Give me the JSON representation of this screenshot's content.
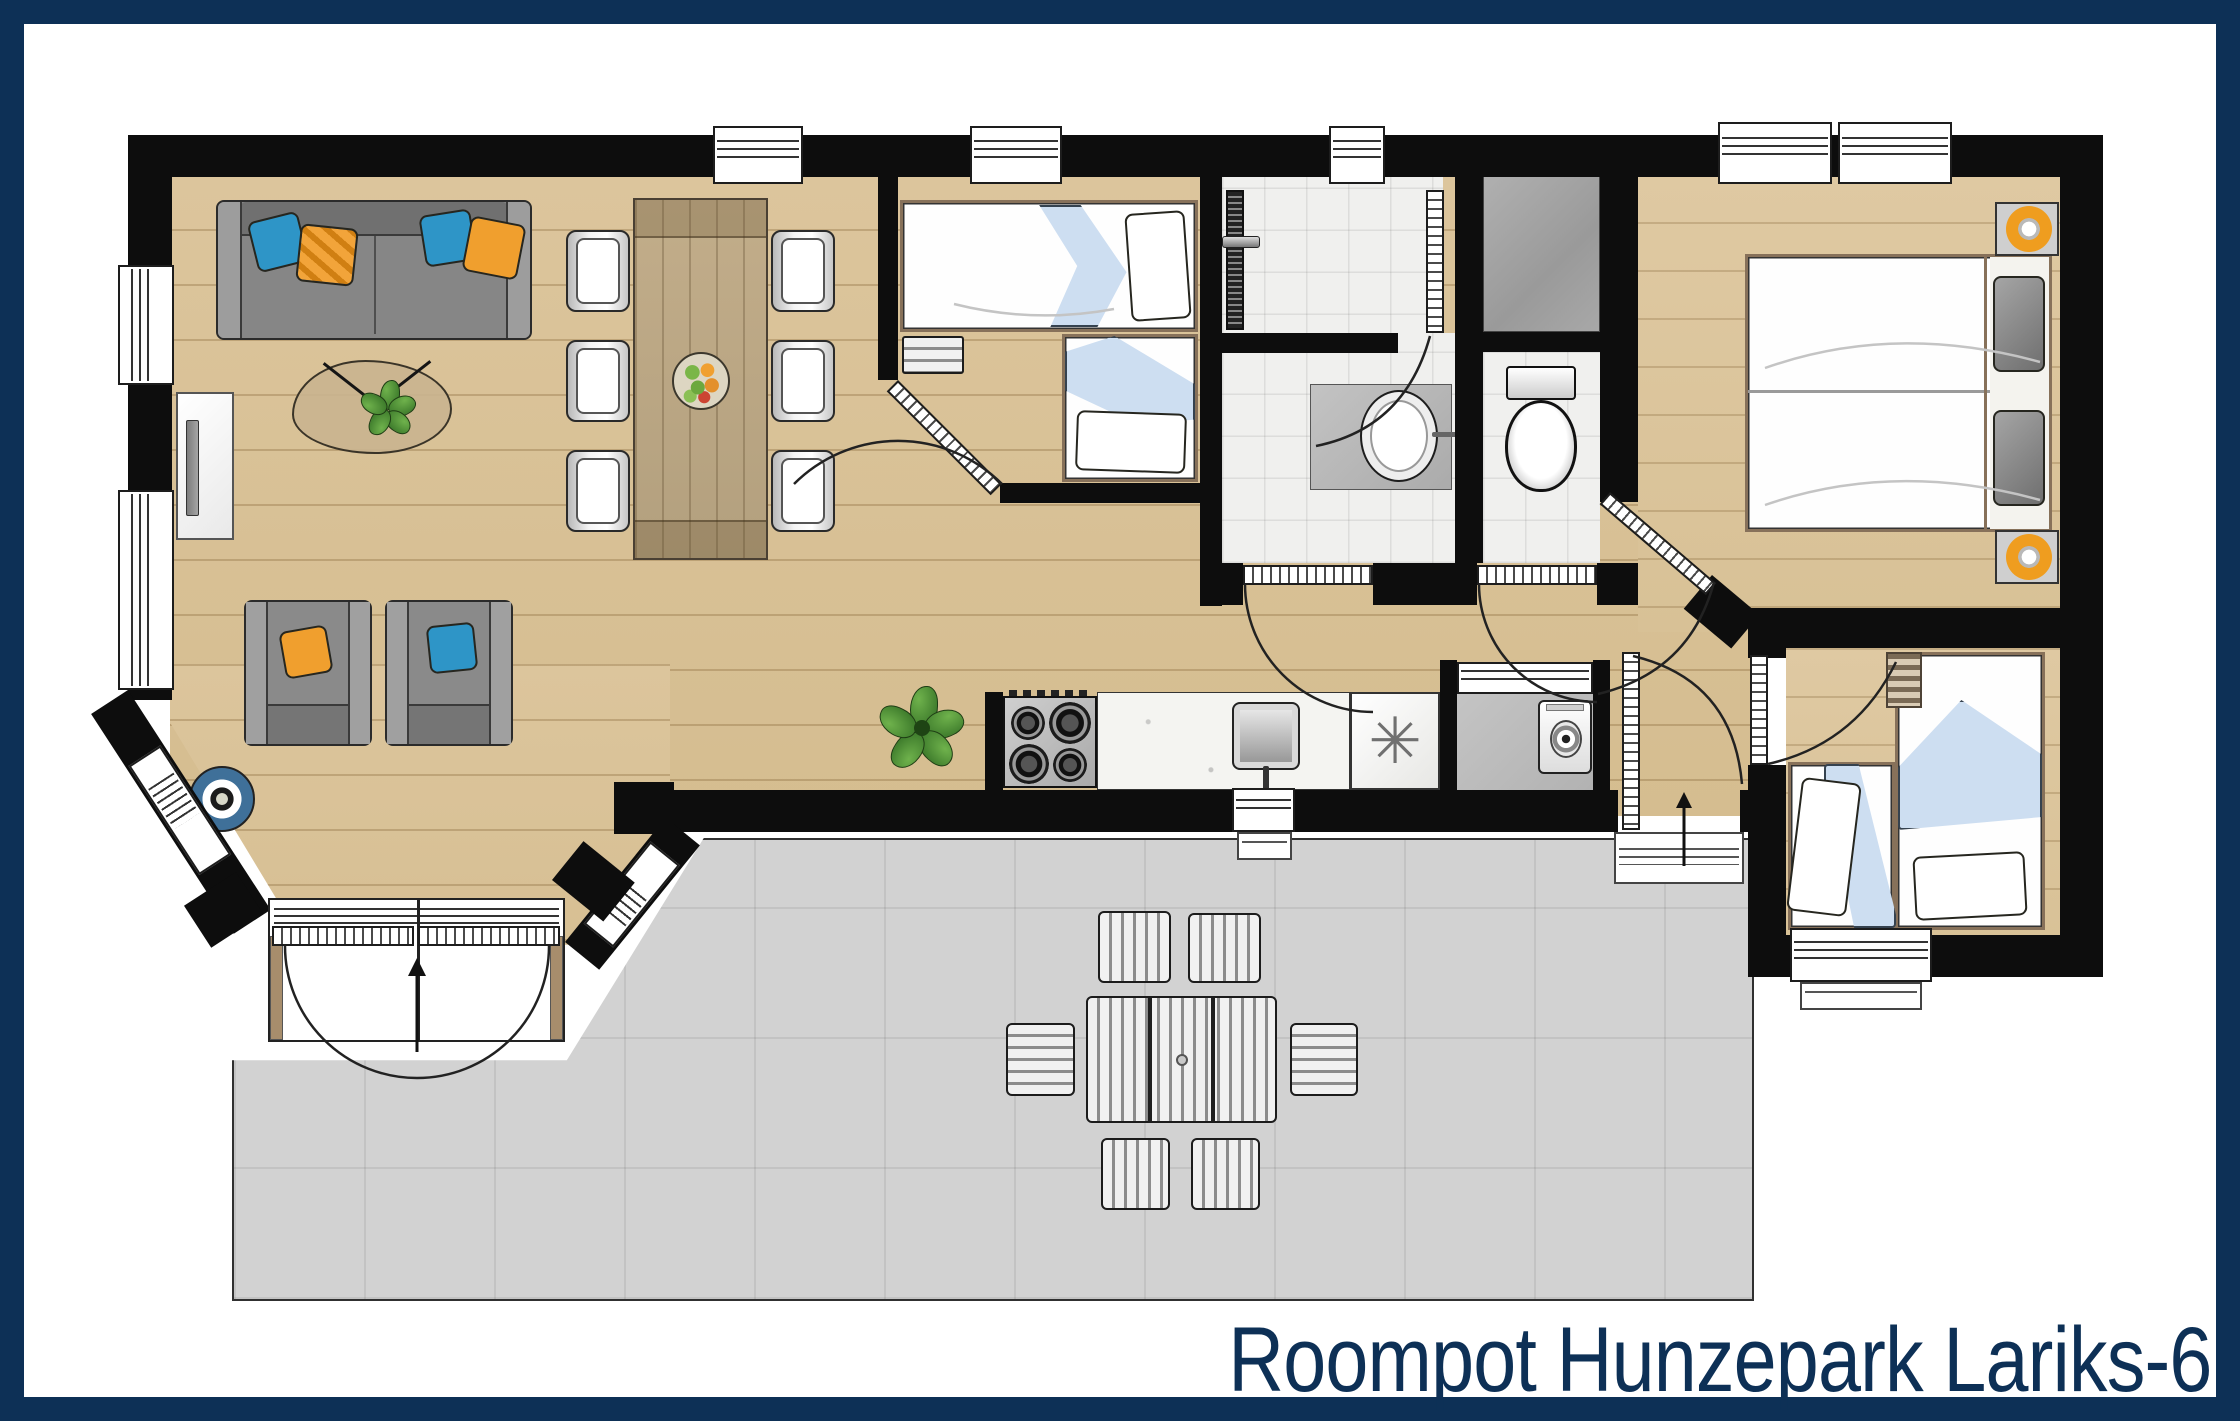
{
  "title": "Roompot Hunzepark Lariks-6",
  "glyphs": {
    "dishwasher": "✳"
  },
  "theme": {
    "navy": "#0d3056",
    "wall": "#0d0d0d",
    "wood": "#d8c095",
    "terrace": "#d2d2d2",
    "tile": "#f0f0ee",
    "sofa_gray": "#868686",
    "pillow_blue": "#2e95c7",
    "pillow_orange": "#f09f2e",
    "fold_blue": "#cddef1",
    "frame_brown": "#87715a",
    "table_wood": "#b9a584",
    "lamp_orange": "#ef9d1f",
    "closet_gray": "#a3a3a3"
  },
  "rooms": [
    {
      "name": "living-room",
      "furniture": [
        "sofa",
        "throw-pillows",
        "tv-cabinet",
        "coffee-table",
        "houseplant",
        "armchair",
        "armchair",
        "speaker"
      ]
    },
    {
      "name": "dining-area",
      "furniture": [
        "dining-table",
        "fruit-bowl",
        "dining-chair",
        "dining-chair",
        "dining-chair",
        "dining-chair",
        "dining-chair",
        "dining-chair"
      ]
    },
    {
      "name": "kitchen",
      "furniture": [
        "gas-hob",
        "counter",
        "kitchen-sink",
        "dishwasher",
        "houseplant"
      ]
    },
    {
      "name": "utility-room",
      "furniture": [
        "washing-machine"
      ]
    },
    {
      "name": "bathroom",
      "furniture": [
        "shower",
        "shower-drain",
        "washbasin",
        "vanity"
      ]
    },
    {
      "name": "toilet-room",
      "furniture": [
        "toilet",
        "storage-closet"
      ]
    },
    {
      "name": "bedroom-1",
      "furniture": [
        "single-bed",
        "single-bed",
        "bench"
      ]
    },
    {
      "name": "bedroom-2",
      "furniture": [
        "double-bed",
        "nightstand-lamp",
        "nightstand-lamp"
      ]
    },
    {
      "name": "bedroom-3",
      "furniture": [
        "single-bed",
        "single-bed",
        "ladder"
      ]
    },
    {
      "name": "terrace",
      "furniture": [
        "garden-table",
        "garden-chair",
        "garden-chair",
        "garden-chair",
        "garden-chair",
        "garden-chair",
        "garden-chair"
      ]
    }
  ]
}
